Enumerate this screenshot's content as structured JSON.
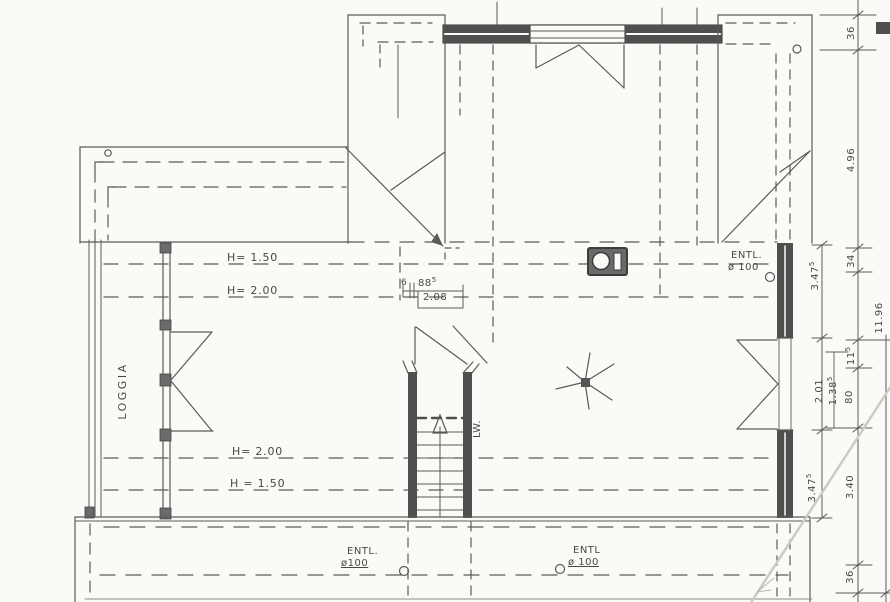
{
  "plan": {
    "room_labels": {
      "loggia": "LOGGIA",
      "stair": "LW."
    },
    "height_lines": {
      "top_h150": "H= 1.50",
      "top_h200": "H= 2.00",
      "bottom_h200": "H= 2.00",
      "bottom_h150": "H = 1.50"
    },
    "vents": {
      "top_right": {
        "name": "ENTL.",
        "size": "ø 100"
      },
      "bottom_left": {
        "name": "ENTL.",
        "size": "ø100"
      },
      "bottom_right": {
        "name": "ENTL",
        "size": "ø 100"
      }
    },
    "stair_dim": {
      "part_a": "6",
      "part_b": "88",
      "part_b_sup": "5",
      "total": "2.08"
    },
    "dims_inner": {
      "seg1": {
        "v": "3.47",
        "sup": "5"
      },
      "seg2": {
        "v": "2.01",
        "sup": ""
      },
      "seg3": {
        "v": "1.38",
        "sup": "5"
      },
      "seg4": {
        "v": "3.47",
        "sup": "5"
      }
    },
    "dims_main": {
      "seg1": {
        "v": "36",
        "sup": ""
      },
      "seg2": {
        "v": "4.96",
        "sup": ""
      },
      "seg3": {
        "v": "34",
        "sup": ""
      },
      "seg4": {
        "v": "11",
        "sup": "5"
      },
      "seg5": {
        "v": "80",
        "sup": ""
      },
      "seg6": {
        "v": "3.40",
        "sup": ""
      },
      "seg7": {
        "v": "36",
        "sup": ""
      }
    },
    "dims_total": {
      "v": "11.96"
    },
    "colors": {
      "paper": "#fafaf7",
      "line": "#5a5a5a",
      "wall_fill": "#4f4f4f",
      "crease": "#cdcac4"
    }
  }
}
